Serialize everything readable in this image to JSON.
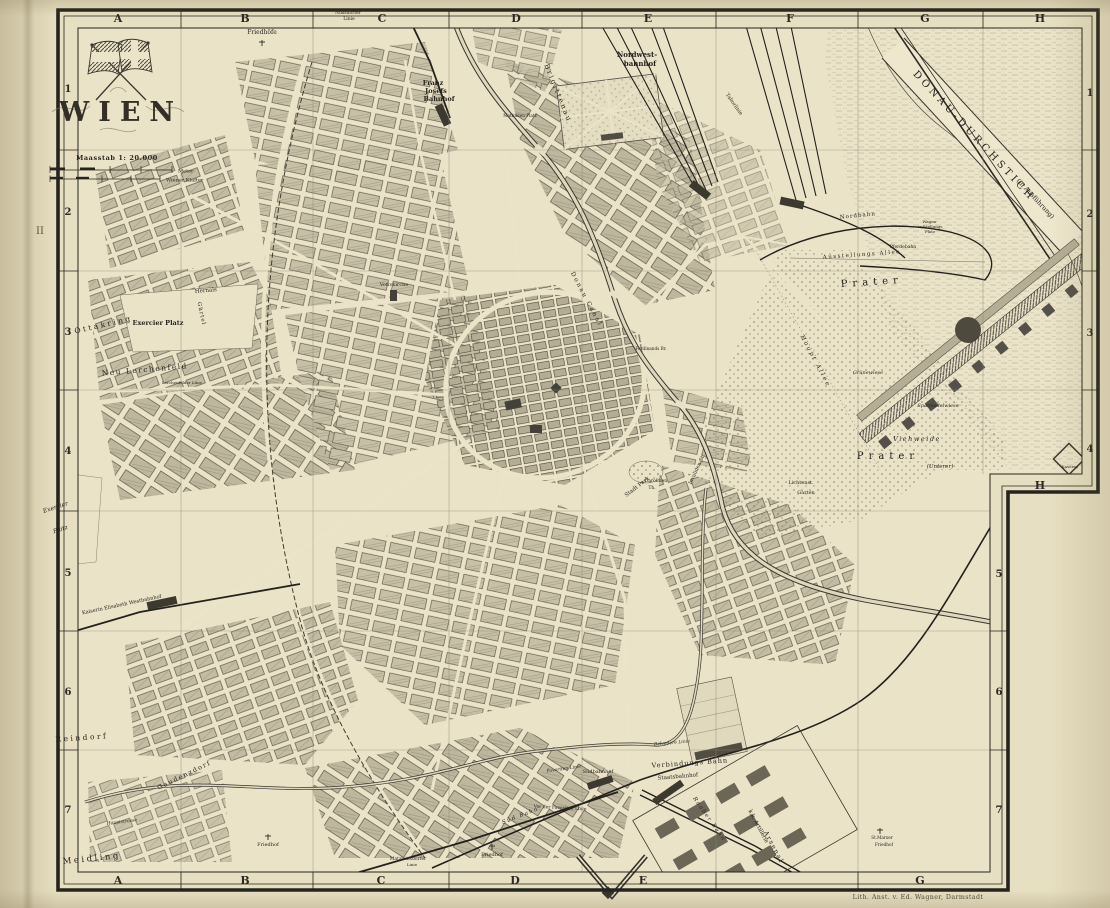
{
  "map": {
    "cartouche": {
      "title": "WIEN",
      "scale": "Maasstab 1: 20.000",
      "unit_meter": "Meter",
      "unit_klafter": "Wiener Klafter"
    },
    "credit": "Lith. Anst. v. Ed. Wagner, Darmstadt",
    "plate_mark": "II",
    "grid": {
      "top_letters": [
        "A",
        "B",
        "C",
        "D",
        "E",
        "F",
        "G",
        "H"
      ],
      "bottom_letters": [
        "A",
        "B",
        "C",
        "D",
        "E",
        "G"
      ],
      "left_numbers": [
        "1",
        "2",
        "3",
        "4",
        "5",
        "6",
        "7"
      ],
      "right_numbers_upper": [
        "1",
        "2",
        "3",
        "4"
      ],
      "right_numbers_lower": [
        "5",
        "6",
        "7"
      ],
      "notch_letter": "H"
    },
    "labels": [
      {
        "t": "Friedhöfe",
        "x": 262,
        "y": 34,
        "s": 6
      },
      {
        "t": "Nussdorfer",
        "x": 348,
        "y": 14,
        "s": 4.5
      },
      {
        "t": "Linie",
        "x": 349,
        "y": 20,
        "s": 4.5
      },
      {
        "t": "Brigittenau",
        "x": 556,
        "y": 94,
        "r": 68,
        "s": 7,
        "sp": 2
      },
      {
        "t": "Nordwest-",
        "x": 637,
        "y": 57,
        "s": 7,
        "w": 1
      },
      {
        "t": "bahnhof",
        "x": 640,
        "y": 66,
        "s": 7,
        "w": 1
      },
      {
        "t": "Franz",
        "x": 433,
        "y": 85,
        "s": 6.5,
        "w": 1
      },
      {
        "t": "Josefs",
        "x": 436,
        "y": 93,
        "s": 6.5,
        "w": 1
      },
      {
        "t": "Bahnhof",
        "x": 439,
        "y": 101,
        "s": 6.5,
        "w": 1
      },
      {
        "t": "Taborlinie",
        "x": 733,
        "y": 105,
        "r": 55,
        "s": 5
      },
      {
        "t": "DONAU-DURCHSTICH",
        "x": 972,
        "y": 138,
        "r": 47,
        "s": 10,
        "sp": 3.5
      },
      {
        "t": "(in Ausführung)",
        "x": 1034,
        "y": 200,
        "r": 47,
        "s": 6.5
      },
      {
        "t": "Nordbahn",
        "x": 858,
        "y": 217,
        "r": -6,
        "s": 5.5,
        "sp": 1
      },
      {
        "t": "Wagen-",
        "x": 930,
        "y": 223,
        "s": 4
      },
      {
        "t": "aufstellungs",
        "x": 930,
        "y": 228,
        "s": 4
      },
      {
        "t": "Platz",
        "x": 930,
        "y": 233,
        "s": 4
      },
      {
        "t": "Pferdebahn",
        "x": 903,
        "y": 248,
        "s": 4.5
      },
      {
        "t": "Ausstellungs Allee",
        "x": 862,
        "y": 256,
        "r": -4,
        "s": 5.5,
        "sp": 1.5
      },
      {
        "t": "Prater",
        "x": 872,
        "y": 285,
        "r": -4,
        "s": 10,
        "sp": 5
      },
      {
        "t": "Haupt Allee",
        "x": 814,
        "y": 362,
        "r": 62,
        "s": 6,
        "sp": 2,
        "i": 1
      },
      {
        "t": "Grünewiese",
        "x": 868,
        "y": 374,
        "s": 5,
        "i": 1
      },
      {
        "t": "Spannadelwiese",
        "x": 938,
        "y": 407,
        "s": 5,
        "i": 1
      },
      {
        "t": "Viehweide",
        "x": 917,
        "y": 441,
        "s": 6.5,
        "sp": 1.5,
        "i": 1
      },
      {
        "t": "Prater",
        "x": 888,
        "y": 459,
        "s": 10,
        "sp": 5
      },
      {
        "t": "(Unterer)",
        "x": 940,
        "y": 468,
        "s": 5.5,
        "i": 1
      },
      {
        "t": "Kaserne",
        "x": 1070,
        "y": 468,
        "s": 4
      },
      {
        "t": "Exercier Platz",
        "x": 158,
        "y": 325,
        "s": 6.5,
        "w": 1
      },
      {
        "t": "Ottakring",
        "x": 104,
        "y": 327,
        "r": -13,
        "s": 7.5,
        "sp": 2.5
      },
      {
        "t": "Neu Lerchenfeld",
        "x": 145,
        "y": 372,
        "r": -5,
        "s": 7.5,
        "sp": 1.5
      },
      {
        "t": "Lerchenfelder Linie",
        "x": 182,
        "y": 384,
        "s": 4
      },
      {
        "t": "Gürtel",
        "x": 200,
        "y": 314,
        "r": 78,
        "s": 5.5,
        "sp": 1
      },
      {
        "t": "Hernals",
        "x": 206,
        "y": 292,
        "r": -5,
        "s": 5.5
      },
      {
        "t": "Votivkirche",
        "x": 394,
        "y": 286,
        "s": 5
      },
      {
        "t": "Mathilden Platz",
        "x": 520,
        "y": 117,
        "s": 4.2
      },
      {
        "t": "Donau Canal",
        "x": 585,
        "y": 300,
        "r": 62,
        "s": 6,
        "sp": 2
      },
      {
        "t": "Ferdinands Br.",
        "x": 651,
        "y": 350,
        "s": 4.2
      },
      {
        "t": "Exercier",
        "x": 56,
        "y": 509,
        "r": -18,
        "s": 6,
        "i": 1
      },
      {
        "t": "Platz",
        "x": 61,
        "y": 531,
        "r": -18,
        "s": 6,
        "i": 1
      },
      {
        "t": "Kaiserin Elisabeth Westbahnhof",
        "x": 122,
        "y": 606,
        "r": -12,
        "s": 5
      },
      {
        "t": "Reindorf",
        "x": 82,
        "y": 740,
        "r": -4,
        "s": 7.5,
        "sp": 2.5
      },
      {
        "t": "Gaudenzdorf",
        "x": 185,
        "y": 777,
        "r": -26,
        "s": 6.5,
        "sp": 1.5
      },
      {
        "t": "Meidling",
        "x": 92,
        "y": 861,
        "r": -6,
        "s": 8.5,
        "sp": 2.5
      },
      {
        "t": "Hauptstrasse",
        "x": 122,
        "y": 823,
        "r": -7,
        "s": 4.5,
        "i": 1
      },
      {
        "t": "Friedhof",
        "x": 268,
        "y": 846,
        "s": 5
      },
      {
        "t": "Matzleinsdorfer",
        "x": 408,
        "y": 860,
        "s": 4.5
      },
      {
        "t": "Linie",
        "x": 412,
        "y": 866,
        "s": 4
      },
      {
        "t": "Friedhof",
        "x": 492,
        "y": 856,
        "s": 5
      },
      {
        "t": "Süd Bahn",
        "x": 521,
        "y": 817,
        "r": -21,
        "s": 5.5,
        "sp": 1.5,
        "i": 1
      },
      {
        "t": "Vor der Favoriten Linie",
        "x": 560,
        "y": 809,
        "r": 3,
        "s": 4.5
      },
      {
        "t": "Favoriten Linie",
        "x": 564,
        "y": 770,
        "r": -8,
        "s": 4.5,
        "i": 1
      },
      {
        "t": "Südbahnhof",
        "x": 598,
        "y": 773,
        "s": 5
      },
      {
        "t": "Staatsbahnhof",
        "x": 678,
        "y": 778,
        "r": -5,
        "s": 5.5
      },
      {
        "t": "Verbindungs Bahn",
        "x": 690,
        "y": 765,
        "r": -4,
        "s": 6.5,
        "sp": 1
      },
      {
        "t": "Belvedere Linie",
        "x": 672,
        "y": 744,
        "r": -5,
        "s": 4.5,
        "i": 1
      },
      {
        "t": "Raaber Bahn",
        "x": 708,
        "y": 820,
        "r": 55,
        "s": 5.5,
        "sp": 1.5,
        "i": 1
      },
      {
        "t": "k.k. Artillerie",
        "x": 757,
        "y": 827,
        "r": 62,
        "s": 5.5
      },
      {
        "t": "Arsenal",
        "x": 772,
        "y": 848,
        "r": 62,
        "s": 6.5,
        "sp": 1.5
      },
      {
        "t": "St.Marxer",
        "x": 882,
        "y": 839,
        "s": 4.2
      },
      {
        "t": "Friedhof",
        "x": 884,
        "y": 846,
        "s": 4.2
      },
      {
        "t": "Lichtenst.",
        "x": 801,
        "y": 484,
        "s": 5
      },
      {
        "t": "Garten",
        "x": 806,
        "y": 494,
        "s": 5
      },
      {
        "t": "Stadt Park",
        "x": 638,
        "y": 488,
        "r": -38,
        "s": 5.5
      },
      {
        "t": "Carolinen",
        "x": 656,
        "y": 482,
        "s": 4.5
      },
      {
        "t": "Th.",
        "x": 652,
        "y": 489,
        "s": 4.5
      },
      {
        "t": "Invaliden St.",
        "x": 698,
        "y": 470,
        "r": -65,
        "s": 5
      }
    ]
  }
}
